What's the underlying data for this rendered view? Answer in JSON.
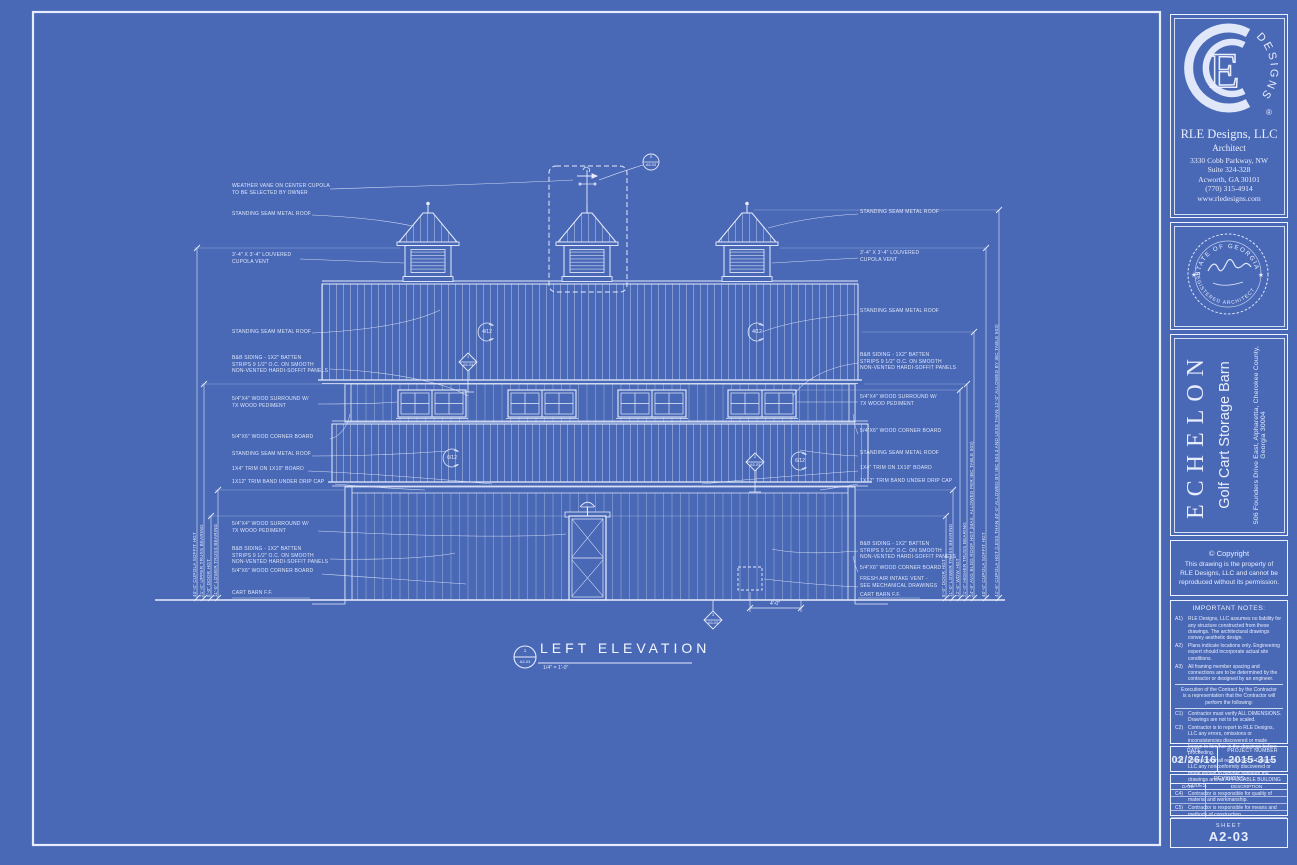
{
  "colors": {
    "paper": "#4968b6",
    "ink": "#e7edfc"
  },
  "titleblock": {
    "firm": {
      "logo_monogram": "E",
      "logo_arc": "DESIGNS",
      "reg": "®",
      "name": "RLE Designs, LLC",
      "role": "Architect",
      "address1": "3330 Cobb Parkway, NW",
      "address2": "Suite 324-328",
      "address3": "Acworth, GA 30101",
      "phone": "(770) 315-4914",
      "website": "www.rledesigns.com"
    },
    "seal": {
      "arc_top": "STATE OF GEORGIA",
      "arc_bottom": "REGISTERED ARCHITECT",
      "star_left": "★",
      "star_right": "★"
    },
    "project": {
      "name": "ECHELON",
      "type": "Golf Cart Storage Barn",
      "address": "506 Founders Drive East, Alpharetta, Cherokee County, Georgia  30004"
    },
    "copyright": {
      "heading": "©  Copyright",
      "line1": "This drawing is the property of",
      "line2": "RLE Designs, LLC and cannot be",
      "line3": "reproduced without its permission."
    },
    "notes": {
      "heading": "IMPORTANT NOTES:",
      "a1_id": "A1)",
      "a1": "RLE Designs, LLC assumes no liability for any structure constructed from these drawings. The architectural drawings convey aesthetic design.",
      "a2_id": "A2)",
      "a2": "Plans indicate locations only. Engineering expert should incorporate actual site conditions.",
      "a3_id": "A3)",
      "a3": "All framing member spacing and connections are to be determined by the contractor or designed by an engineer.",
      "execution": "Execution of the Contract by the Contractor is a representation that the Contractor will perform the following:",
      "c1_id": "C1)",
      "c1": "Contractor must verify ALL DIMENSIONS. Drawings are not to be scaled.",
      "c2_id": "C2)",
      "c2": "Contractor is to report to RLE Designs, LLC any errors, omissions or inconsistencies discovered or made known to him/her in the drawings before proceeding.",
      "c3_id": "C3)",
      "c3": "Contractor shall report to RLE Designs, LLC any nonconformity discovered or made known to him/her between the drawings and all APPLICABLE BUILDING CODES.",
      "c4_id": "C4)",
      "c4": "Contractor is responsible for quality of material and workmanship.",
      "c5_id": "C5)",
      "c5": "Contractor is responsible for means and methods of construction."
    },
    "date_label": "DATE",
    "date_value": "02/26/16",
    "project_number_label": "PROJECT  NUMBER",
    "project_number_value": "2015-315",
    "revisions": {
      "heading": "REVISIONS",
      "col_date": "DATE",
      "col_description": "DESCRIPTION"
    },
    "sheet_label": "SHEET",
    "sheet_number": "A2-03"
  },
  "drawing": {
    "view_title": "LEFT ELEVATION",
    "view_scale": "1/4\" = 1'-0\"",
    "view_callout": {
      "num": "1",
      "sheet": "A2-03"
    },
    "labels_left": [
      "WEATHER VANE ON CENTER CUPOLA\nTO BE SELECTED BY OWNER",
      "STANDING SEAM METAL ROOF",
      "3'-4\" x 3'-4\" LOUVERED\nCUPOLA VENT",
      "STANDING SEAM METAL ROOF",
      "B&B SIDING - 1x2\" BATTEN\nSTRIPS 9 1/2\" O.C. ON SMOOTH\nNON-VENTED HARDI-SOFFIT PANELS",
      "5/4\"x4\" WOOD SURROUND W/\n7x WOOD PEDIMENT",
      "5/4\"x6\" WOOD CORNER BOARD",
      "STANDING SEAM METAL ROOF",
      "1x4\" TRIM ON 1x10\" BOARD",
      "1x12\" TRIM BAND UNDER DRIP CAP",
      "5/4\"x4\" WOOD SURROUND W/\n7x WOOD PEDIMENT",
      "B&B SIDING - 1x2\" BATTEN\nSTRIPS 9 1/2\" O.C. ON SMOOTH\nNON-VENTED HARDI-SOFFIT PANELS",
      "5/4\"x6\" WOOD CORNER BOARD",
      "CART BARN F.F."
    ],
    "labels_right": [
      "STANDING SEAM METAL ROOF",
      "3'-4\" x 3'-4\" LOUVERED\nCUPOLA VENT",
      "STANDING SEAM METAL ROOF",
      "B&B SIDING - 1x2\" BATTEN\nSTRIPS 9 1/2\" O.C. ON SMOOTH\nNON-VENTED HARDI-SOFFIT PANELS",
      "5/4\"x4\" WOOD SURROUND W/\n7x WOOD PEDIMENT",
      "5/4\"x6\" WOOD CORNER BOARD",
      "STANDING SEAM METAL ROOF",
      "1x4\" TRIM ON 1x10\" BOARD",
      "1x12\" TRIM BAND UNDER DRIP CAP",
      "B&B SIDING - 1x2\" BATTEN\nSTRIPS 9 1/2\" O.C. ON SMOOTH\nNON-VENTED HARDI-SOFFIT PANELS",
      "5/4\"x6\" WOOD CORNER BOARD",
      "FRESH AIR INTAKE VENT -\nSEE MECHANICAL DRAWINGS",
      "CART BARN F.F."
    ],
    "dims_left": [
      "40'-0\" CUPOLA SOFFIT HGT",
      "21'-0\" UPPER TRUSS BEARING",
      "8'-0\" DOOR HGT",
      "11'-0\" LOWER TRUSS BEARING"
    ],
    "dims_right": [
      "8'-0\" DOOR HGT",
      "11'-0\" LOWER TRUSS BEARING",
      "12'-6\" WDW HGT",
      "21'-0\" HIGHER TRUSS BEARING",
      "24'-9\" AVG BLDG ROOF HGT (MAX. ALLOWED PER IBC TABLE 503)",
      "40'-0\" CUPOLA SOFFIT HGT",
      "41'-6\" CUPOLA HGT (LESS THAN 40'-0\" ALLOWED BY IBC 504.3 AND LESS THAN 12'-0\" ALLOWED BY IBC TABLE 503)"
    ],
    "pitch_upper": "4/12",
    "pitch_lower": "6/12",
    "callout_vane": {
      "num": "5",
      "sheet": "A5-03"
    },
    "callout_d1": {
      "num": "1",
      "sheet": "A5-03"
    },
    "callout_d2": {
      "num": "2",
      "sheet": "A5-03"
    },
    "callout_d3": {
      "num": "3",
      "sheet": "A5-03"
    },
    "dim_vent": "4'-0\""
  }
}
